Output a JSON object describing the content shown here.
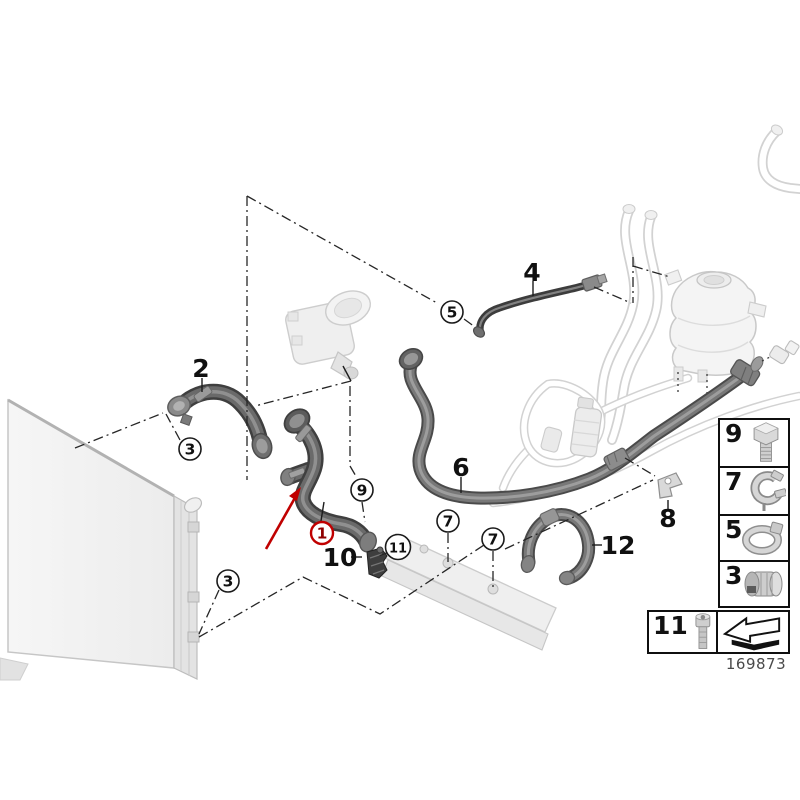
{
  "part_number": "169873",
  "colors": {
    "highlight_red": "#c00000",
    "highlight_digit": "#8f0000",
    "line_black": "#1a1a1a",
    "hose_dark": "#3f3f3f",
    "hose_mid": "#6a6a6a",
    "part_light": "#f0f0f0"
  },
  "diagram": {
    "callouts": [
      {
        "num": "1",
        "x": 322,
        "y": 533,
        "style": "red"
      },
      {
        "num": "3",
        "x": 190,
        "y": 449,
        "style": "black"
      },
      {
        "num": "3",
        "x": 228,
        "y": 581,
        "style": "black"
      },
      {
        "num": "5",
        "x": 452,
        "y": 312,
        "style": "black"
      },
      {
        "num": "7",
        "x": 448,
        "y": 521,
        "style": "black"
      },
      {
        "num": "7",
        "x": 493,
        "y": 539,
        "style": "black"
      },
      {
        "num": "9",
        "x": 362,
        "y": 490,
        "style": "black"
      },
      {
        "num": "11",
        "x": 398,
        "y": 547,
        "style": "black"
      }
    ],
    "part_labels": [
      {
        "num": "2",
        "x": 201,
        "y": 368
      },
      {
        "num": "4",
        "x": 532,
        "y": 272
      },
      {
        "num": "6",
        "x": 461,
        "y": 467
      },
      {
        "num": "8",
        "x": 668,
        "y": 518
      },
      {
        "num": "10",
        "x": 340,
        "y": 557
      },
      {
        "num": "12",
        "x": 618,
        "y": 545
      }
    ]
  },
  "legend": {
    "column_items": [
      {
        "number": "9",
        "icon": "hex-bolt-icon"
      },
      {
        "number": "7",
        "icon": "spring-clip-icon"
      },
      {
        "number": "5",
        "icon": "hose-clamp-icon"
      },
      {
        "number": "3",
        "icon": "quick-coupling-icon"
      }
    ],
    "row_items": [
      {
        "number": "11",
        "icon": "socket-bolt-icon"
      }
    ],
    "direction_icon": "direction-arrow-icon"
  }
}
